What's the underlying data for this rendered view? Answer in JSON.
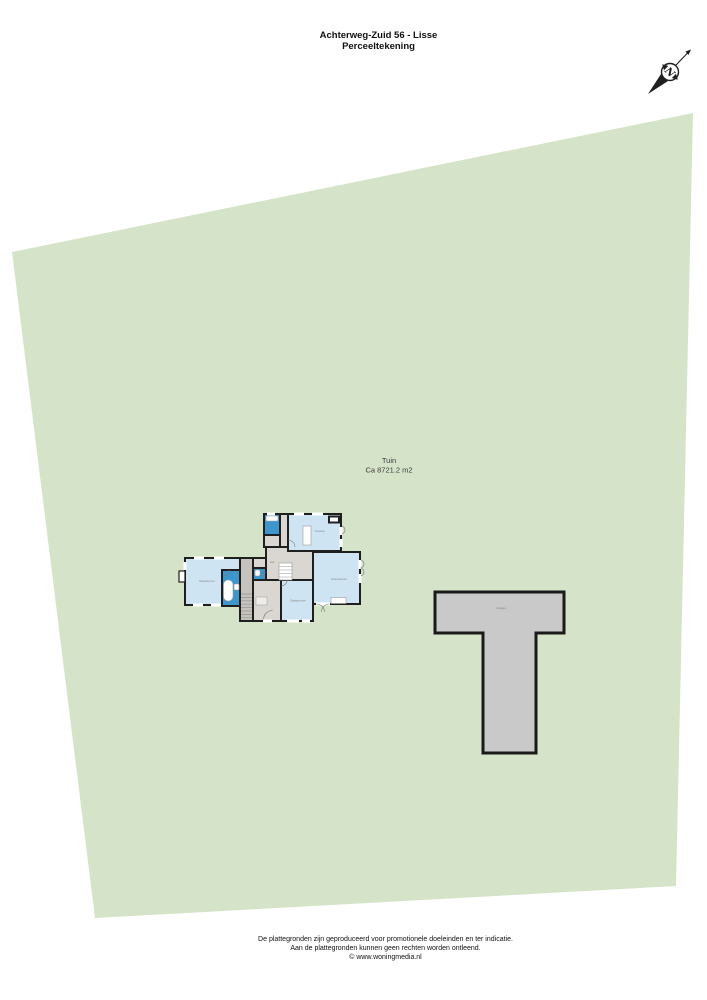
{
  "header": {
    "title_line1": "Achterweg-Zuid 56 - Lisse",
    "title_line2": "Perceeltekening"
  },
  "compass": {
    "label": "N"
  },
  "plot": {
    "name": "Tuin",
    "area": "Ca 8721.2 m2",
    "fill": "#d5e4c8"
  },
  "house": {
    "rooms": {
      "kitchen": "Keuken",
      "living": "Woonkamer",
      "bedroom_left": "Slaapkamer",
      "bedroom_mid": "Slaapkamer",
      "hall": "Hal"
    },
    "colors": {
      "room_fill": "#cfe4f3",
      "wet_room_fill": "#3d97cc",
      "floor_fill": "#dad7d2",
      "wall": "#1f1f1f"
    }
  },
  "outbuilding": {
    "label": "Garage",
    "fill": "#c9c9c9"
  },
  "footer": {
    "line1": "De plattegronden zijn geproduceerd voor promotionele doeleinden en ter indicatie.",
    "line2": "Aan de plattegronden kunnen geen rechten worden ontleend.",
    "line3": "© www.woningmedia.nl"
  }
}
